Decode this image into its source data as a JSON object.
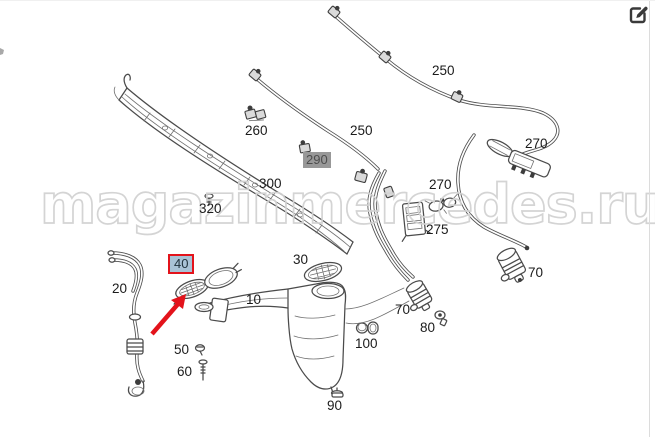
{
  "header": {
    "edit_button": {
      "icon": "edit-pencil-square-icon"
    }
  },
  "watermark": {
    "text": "magazinmercedes.ru",
    "color": "#d2d2d2"
  },
  "colors": {
    "line_art": "#4b4b4b",
    "label_text": "#1b1b1b",
    "highlight_red": "#e3131b",
    "selected_label_fill": "#a9c3d6",
    "muted_label_fill": "#989898",
    "muted_label_text": "#4d4d4d",
    "watermark": "#d2d2d2"
  },
  "diagram": {
    "description": "Windshield washer system exploded parts diagram",
    "selected_part": "40",
    "labels": [
      {
        "id": "250-upper",
        "text": "250",
        "x": 432,
        "y": 63,
        "style": "plain"
      },
      {
        "id": "250-lower",
        "text": "250",
        "x": 350,
        "y": 123,
        "style": "plain"
      },
      {
        "id": "260",
        "text": "260",
        "x": 245,
        "y": 123,
        "style": "plain"
      },
      {
        "id": "290",
        "text": "290",
        "x": 303,
        "y": 151,
        "style": "gray-box"
      },
      {
        "id": "300",
        "text": "300",
        "x": 259,
        "y": 176,
        "style": "plain"
      },
      {
        "id": "320",
        "text": "320",
        "x": 199,
        "y": 201,
        "style": "plain"
      },
      {
        "id": "270-right",
        "text": "270",
        "x": 525,
        "y": 136,
        "style": "plain"
      },
      {
        "id": "270-left",
        "text": "270",
        "x": 429,
        "y": 177,
        "style": "plain"
      },
      {
        "id": "275",
        "text": "275",
        "x": 426,
        "y": 222,
        "style": "plain"
      },
      {
        "id": "20",
        "text": "20",
        "x": 112,
        "y": 281,
        "style": "plain"
      },
      {
        "id": "30",
        "text": "30",
        "x": 293,
        "y": 252,
        "style": "plain"
      },
      {
        "id": "10",
        "text": "10",
        "x": 246,
        "y": 292,
        "style": "plain"
      },
      {
        "id": "40",
        "text": "40",
        "x": 168,
        "y": 253,
        "style": "red-box"
      },
      {
        "id": "50",
        "text": "50",
        "x": 174,
        "y": 342,
        "style": "plain"
      },
      {
        "id": "60",
        "text": "60",
        "x": 177,
        "y": 364,
        "style": "plain"
      },
      {
        "id": "70-left",
        "text": "70",
        "x": 395,
        "y": 302,
        "style": "plain"
      },
      {
        "id": "80",
        "text": "80",
        "x": 420,
        "y": 320,
        "style": "plain"
      },
      {
        "id": "100",
        "text": "100",
        "x": 355,
        "y": 336,
        "style": "plain"
      },
      {
        "id": "90",
        "text": "90",
        "x": 327,
        "y": 398,
        "style": "plain"
      },
      {
        "id": "70-right",
        "text": "70",
        "x": 528,
        "y": 265,
        "style": "plain"
      }
    ]
  }
}
